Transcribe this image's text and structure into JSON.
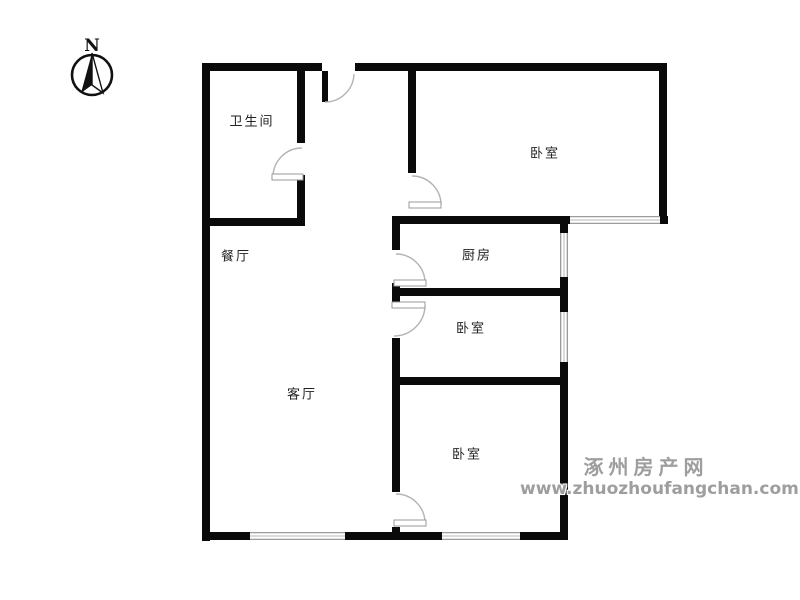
{
  "canvas": {
    "width": 800,
    "height": 600,
    "background": "#ffffff"
  },
  "colors": {
    "wall": "#0a0a0a",
    "door_arc": "#b3b3b3",
    "door_panel_border": "#999999",
    "window_edge": "#8f8f8f",
    "window_mid": "#c4c4c4",
    "label_text": "#222222",
    "watermark_text": "#9e9e9e",
    "compass_ink": "#111111"
  },
  "compass": {
    "label": "N",
    "cx": 92,
    "cy": 75,
    "r": 20
  },
  "rooms": [
    {
      "id": "bathroom",
      "label": "卫生间",
      "cx": 252,
      "cy": 120
    },
    {
      "id": "bedroom-top",
      "label": "卧室",
      "cx": 545,
      "cy": 152
    },
    {
      "id": "dining-room",
      "label": "餐厅",
      "cx": 236,
      "cy": 255
    },
    {
      "id": "kitchen",
      "label": "厨房",
      "cx": 477,
      "cy": 254
    },
    {
      "id": "bedroom-middle",
      "label": "卧室",
      "cx": 471,
      "cy": 327
    },
    {
      "id": "living-room",
      "label": "客厅",
      "cx": 302,
      "cy": 393
    },
    {
      "id": "bedroom-bottom",
      "label": "卧室",
      "cx": 467,
      "cy": 453
    }
  ],
  "plan": {
    "walls": [
      {
        "id": "top-wall-left",
        "rect": [
          202,
          63,
          120,
          8
        ]
      },
      {
        "id": "top-wall-right",
        "rect": [
          355,
          63,
          312,
          8
        ]
      },
      {
        "id": "left-wall",
        "rect": [
          202,
          63,
          8,
          478
        ]
      },
      {
        "id": "bottom-wall",
        "rect": [
          202,
          532,
          366,
          8
        ]
      },
      {
        "id": "right-wall-upper",
        "rect": [
          659,
          63,
          8,
          161
        ]
      },
      {
        "id": "right-wall-lower",
        "rect": [
          560,
          222,
          8,
          318
        ]
      },
      {
        "id": "bathroom-right-wall-a",
        "rect": [
          297,
          63,
          8,
          80
        ]
      },
      {
        "id": "bathroom-right-wall-b",
        "rect": [
          297,
          175,
          8,
          51
        ]
      },
      {
        "id": "bathroom-bottom-wall",
        "rect": [
          202,
          218,
          103,
          8
        ]
      },
      {
        "id": "mid-horizontal-wall",
        "rect": [
          392,
          216,
          276,
          8
        ]
      },
      {
        "id": "bedroom-top-left-wall",
        "rect": [
          408,
          63,
          8,
          110
        ]
      },
      {
        "id": "kitchen-left-wall-a",
        "rect": [
          392,
          216,
          8,
          34
        ]
      },
      {
        "id": "kitchen-left-wall-b",
        "rect": [
          392,
          283,
          8,
          19
        ]
      },
      {
        "id": "inner-left-wall-c",
        "rect": [
          392,
          338,
          8,
          154
        ]
      },
      {
        "id": "inner-left-wall-d",
        "rect": [
          392,
          527,
          8,
          13
        ]
      },
      {
        "id": "kitchen-bedroom-divider",
        "rect": [
          392,
          288,
          176,
          8
        ]
      },
      {
        "id": "bedroom-middle-bottom",
        "rect": [
          392,
          377,
          176,
          8
        ]
      },
      {
        "id": "entry-door-stub",
        "rect": [
          322,
          71,
          6,
          31
        ]
      }
    ],
    "windows": [
      {
        "id": "window-bottom-left",
        "rect": [
          250,
          532,
          95,
          8
        ],
        "orient": "h"
      },
      {
        "id": "window-bottom-right",
        "rect": [
          442,
          532,
          78,
          8
        ],
        "orient": "h"
      },
      {
        "id": "window-bedroom-top",
        "rect": [
          570,
          216,
          90,
          8
        ],
        "orient": "h"
      },
      {
        "id": "window-kitchen-east",
        "rect": [
          560,
          233,
          8,
          44
        ],
        "orient": "v"
      },
      {
        "id": "window-bedroom-east",
        "rect": [
          560,
          312,
          8,
          50
        ],
        "orient": "v"
      }
    ],
    "doors": [
      {
        "id": "entry-door",
        "path": "M 325 102 A 29 29 0 0 0 354 74",
        "panel": null
      },
      {
        "id": "bathroom-door",
        "path": "M 302 148 A 29 29 0 0 0 273 177",
        "panel": [
          272,
          174,
          31,
          6
        ]
      },
      {
        "id": "bedroom-top-door",
        "path": "M 412 176 A 29 29 0 0 1 441 205",
        "panel": [
          409,
          202,
          32,
          6
        ]
      },
      {
        "id": "kitchen-door",
        "path": "M 396 254 A 29 29 0 0 1 425 283",
        "panel": [
          394,
          280,
          32,
          6
        ]
      },
      {
        "id": "bedroom-middle-door",
        "path": "M 425 305 A 31 31 0 0 1 394 336",
        "panel": [
          392,
          302,
          33,
          6
        ]
      },
      {
        "id": "bedroom-bottom-door",
        "path": "M 396 494 A 29 29 0 0 1 425 523",
        "panel": [
          394,
          520,
          32,
          6
        ]
      }
    ]
  },
  "watermark": {
    "line1": "涿州房产网",
    "line2": "www.zhuozhoufangchan.com"
  }
}
